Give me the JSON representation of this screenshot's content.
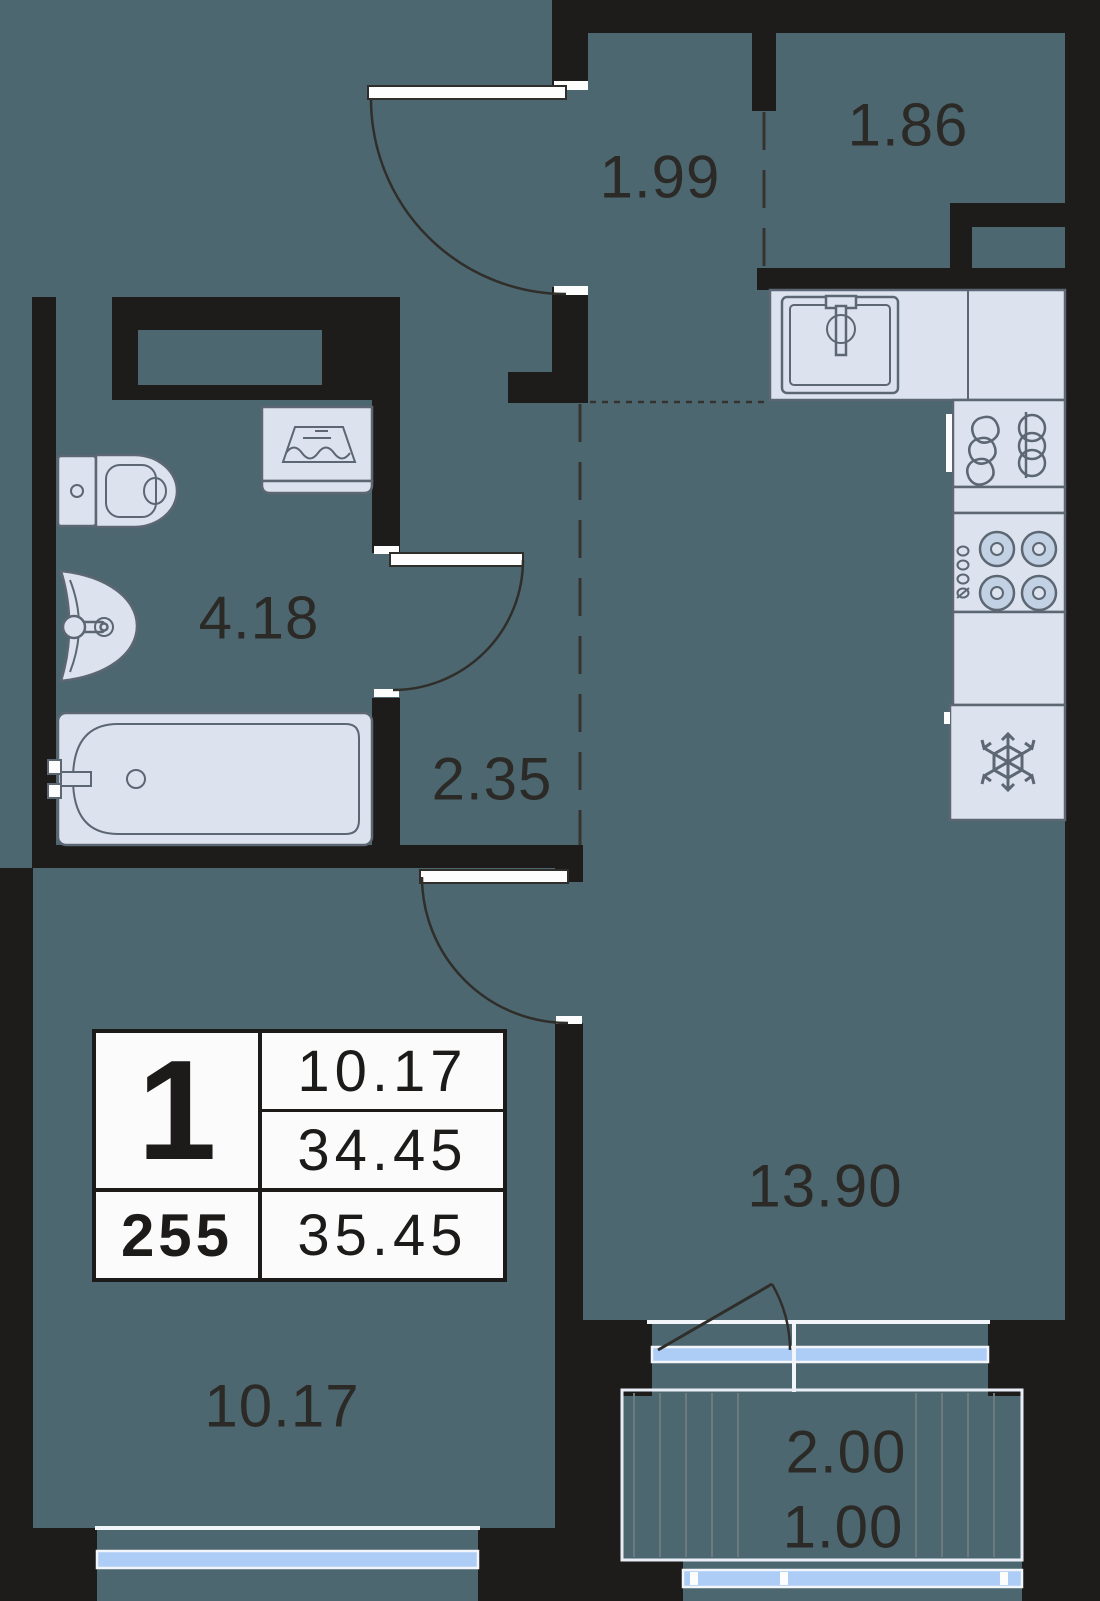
{
  "floorplan": {
    "unit_summary": {
      "rooms_count": "1",
      "unit_number": "255",
      "living_area": "10.17",
      "area_without_balcony": "34.45",
      "total_area": "35.45"
    },
    "room_labels": {
      "hallway": "1.99",
      "storage": "1.86",
      "bathroom": "4.18",
      "corridor": "2.35",
      "kitchen_living": "13.90",
      "bedroom": "10.17",
      "balcony": "2.00",
      "balcony_reduced": "1.00"
    },
    "colors": {
      "floor": "#4d6770",
      "walls": "#1d1c1a",
      "fixtures_fill": "#dce3ee",
      "fixtures_stroke": "#5c6773",
      "glazing": "#aecdf6",
      "table_background": "#fbfbfb"
    },
    "fixture_icons": [
      "toilet-icon",
      "wash-basin-icon",
      "bathtub-icon",
      "washing-machine-icon",
      "kitchen-sink-icon",
      "dish-dryer-icon",
      "stove-icon",
      "fridge-snowflake-icon"
    ]
  }
}
